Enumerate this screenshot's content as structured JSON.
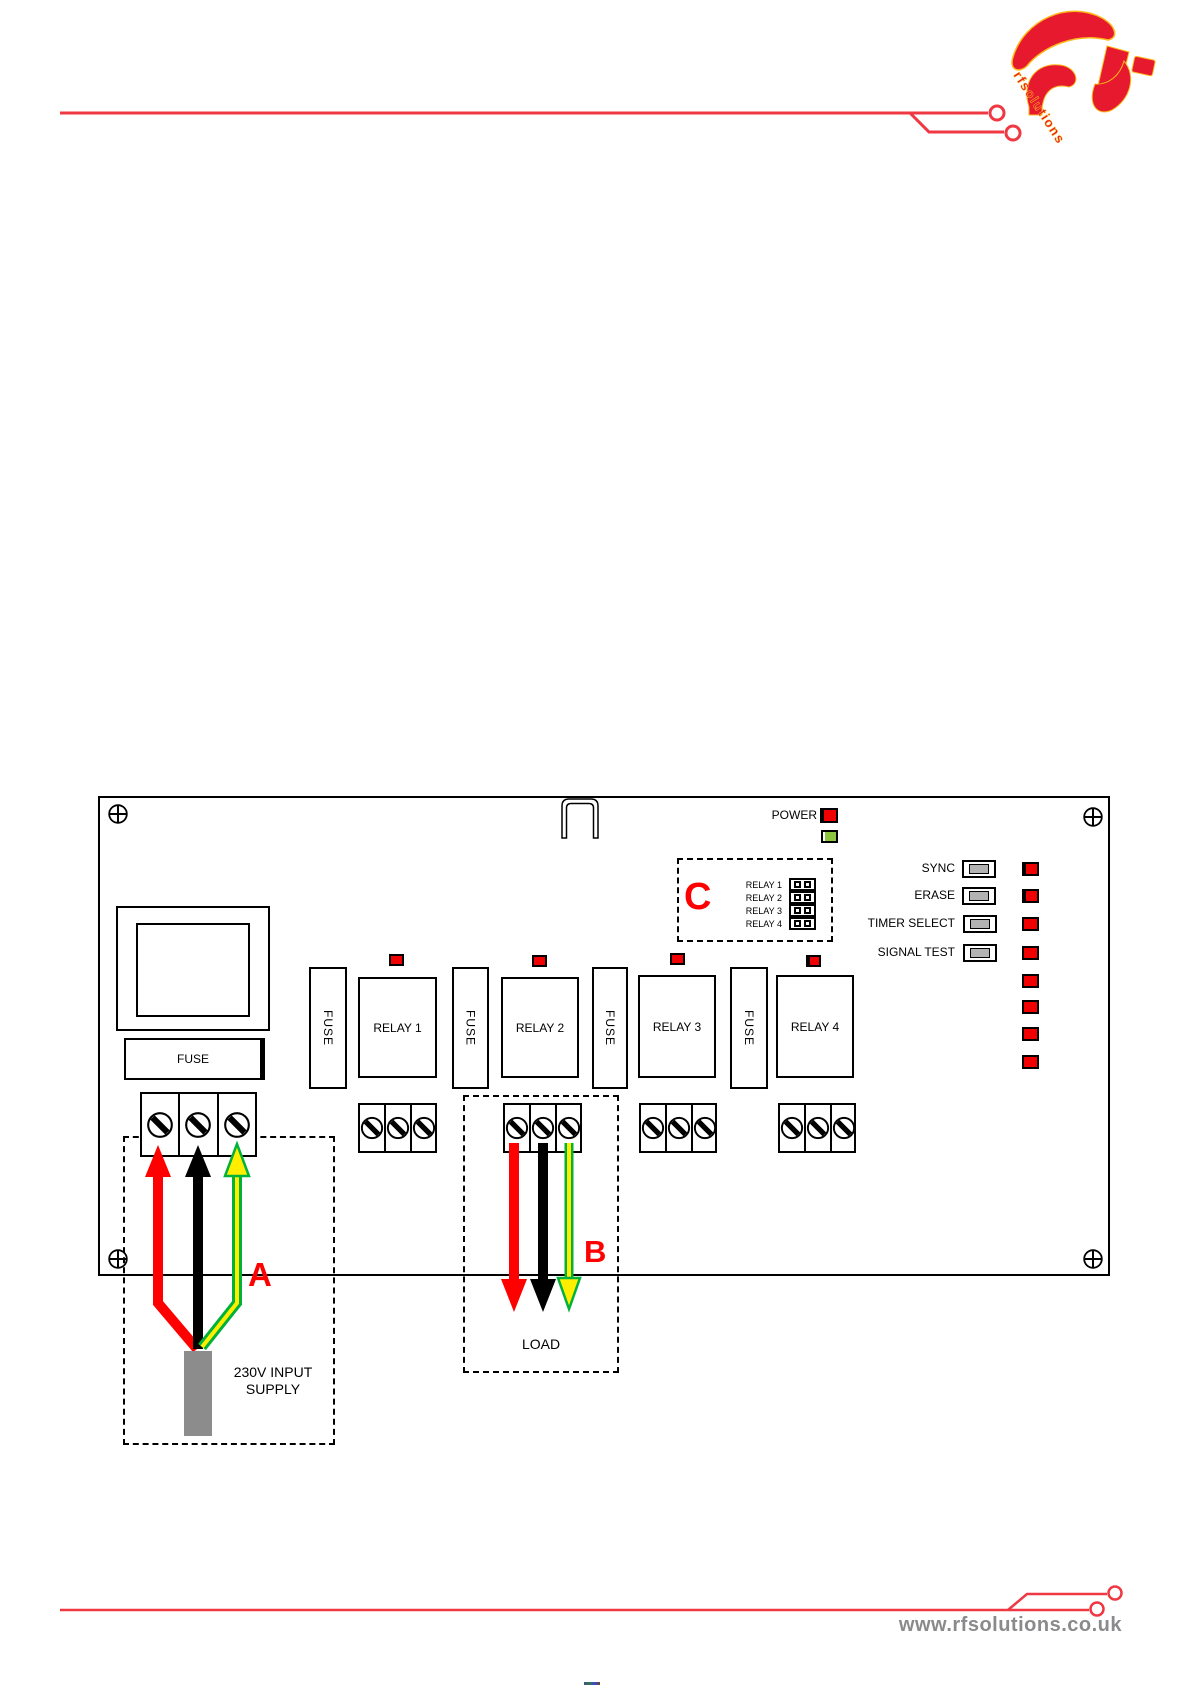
{
  "header": {
    "logo": {
      "text": "rfsolutions",
      "red": "#e6192e",
      "yellow": "#ffb81c"
    }
  },
  "board": {
    "power_label": "POWER",
    "controls": [
      {
        "label": "SYNC"
      },
      {
        "label": "ERASE"
      },
      {
        "label": "TIMER SELECT"
      },
      {
        "label": "SIGNAL TEST"
      }
    ],
    "right_led_column_count": 8,
    "jumper_box": {
      "rows": [
        "RELAY 1",
        "RELAY 2",
        "RELAY 3",
        "RELAY 4"
      ]
    },
    "relays": [
      {
        "label": "RELAY 1"
      },
      {
        "label": "RELAY 2"
      },
      {
        "label": "RELAY 3"
      },
      {
        "label": "RELAY 4"
      }
    ],
    "fuses": {
      "main": "FUSE",
      "vertical": [
        "FUSE",
        "FUSE",
        "FUSE",
        "FUSE"
      ]
    }
  },
  "annotations": {
    "input": {
      "label": "A",
      "caption_line1": "230V INPUT",
      "caption_line2": "SUPPLY"
    },
    "output": {
      "label": "B",
      "caption": "LOAD"
    },
    "jumpers": {
      "label": "C"
    }
  },
  "footer": {
    "website": "www.rfsolutions.co.uk"
  },
  "colors": {
    "diagram_red": "#ff0000",
    "trace_red": "#ef3842",
    "logo_red": "#e6192e",
    "logo_yellow": "#ffb81c",
    "earth_green": "#00b23a",
    "earth_yellow": "#ffee00",
    "led_green": "#8cc63e",
    "button_gray": "#b3b3b3",
    "plug_gray": "#8c8c8c",
    "footer_text_gray": "#8a8a8c"
  }
}
